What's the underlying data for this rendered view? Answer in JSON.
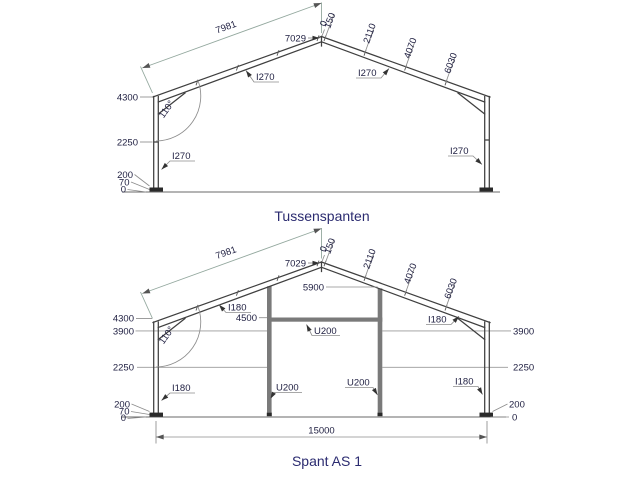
{
  "window": {
    "background": "#ffffff"
  },
  "colors": {
    "member_line": "#3f3f3f",
    "dimension_line": "#8c8c8c",
    "dimension_line_green": "#93a89e",
    "dimension_text": "#1e1e40",
    "title_text": "#2b2b70",
    "steel_fill": "#7a7a7a"
  },
  "upper": {
    "title": "Tussenspanten",
    "dims": {
      "slope_length": "7981",
      "ridge_height": "7029",
      "purlins": {
        "p0": "0",
        "p1": "150",
        "p2": "2110",
        "p3": "4070",
        "p4": "6030"
      },
      "eave_height": "4300",
      "girt_level": "2250",
      "plate_level": "200",
      "grout_level": "70",
      "ground_level": "0",
      "eave_angle": "110°"
    },
    "profiles": {
      "rafter_left": "I270",
      "rafter_right": "I270",
      "column_left": "I270",
      "column_right": "I270"
    }
  },
  "lower": {
    "title": "Spant AS 1",
    "dims": {
      "slope_length": "7981",
      "ridge_height": "7029",
      "purlins": {
        "p0": "0",
        "p1": "150",
        "p2": "2110",
        "p3": "4070",
        "p4": "6030"
      },
      "eave_height": "4300",
      "left": {
        "girt_top": "3900",
        "girt_mid": "2250",
        "plate": "200",
        "grout": "70",
        "ground": "0"
      },
      "right": {
        "girt_top": "3900",
        "girt_mid": "2250",
        "plate": "200",
        "ground": "0"
      },
      "inner_column_top": "5900",
      "beam_level": "4500",
      "span": "15000",
      "eave_angle": "110°"
    },
    "profiles": {
      "rafter_left": "I180",
      "rafter_right": "I180",
      "column_left": "I180",
      "column_right": "I180",
      "inner_column_left": "U200",
      "inner_column_right": "U200",
      "beam": "U200"
    }
  }
}
